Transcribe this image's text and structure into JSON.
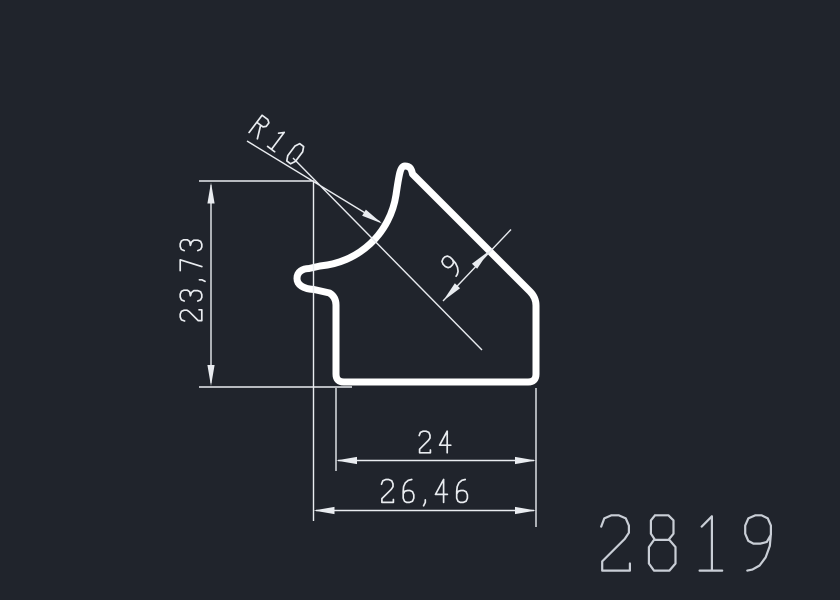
{
  "window": {
    "type": "cad-profile-drawing",
    "background": "#20242c"
  },
  "colors": {
    "profile_outline": "#ffffff",
    "dimension_lines": "#e9ecf0",
    "dimension_text": "#e9ecf0",
    "part_number_text": "#c9ced6"
  },
  "drawing": {
    "part_number": "2819",
    "dimensions": [
      {
        "id": "radius",
        "label": "R10",
        "value": 10,
        "kind": "radius-leader"
      },
      {
        "id": "height",
        "label": "23,73",
        "value": 23.73,
        "kind": "linear-vertical"
      },
      {
        "id": "wall_thickness",
        "label": "9",
        "value": 9,
        "kind": "linear-aligned"
      },
      {
        "id": "width_inner",
        "label": "24",
        "value": 24,
        "kind": "linear-horizontal"
      },
      {
        "id": "width_overall",
        "label": "26,46",
        "value": 26.46,
        "kind": "linear-horizontal"
      }
    ]
  }
}
